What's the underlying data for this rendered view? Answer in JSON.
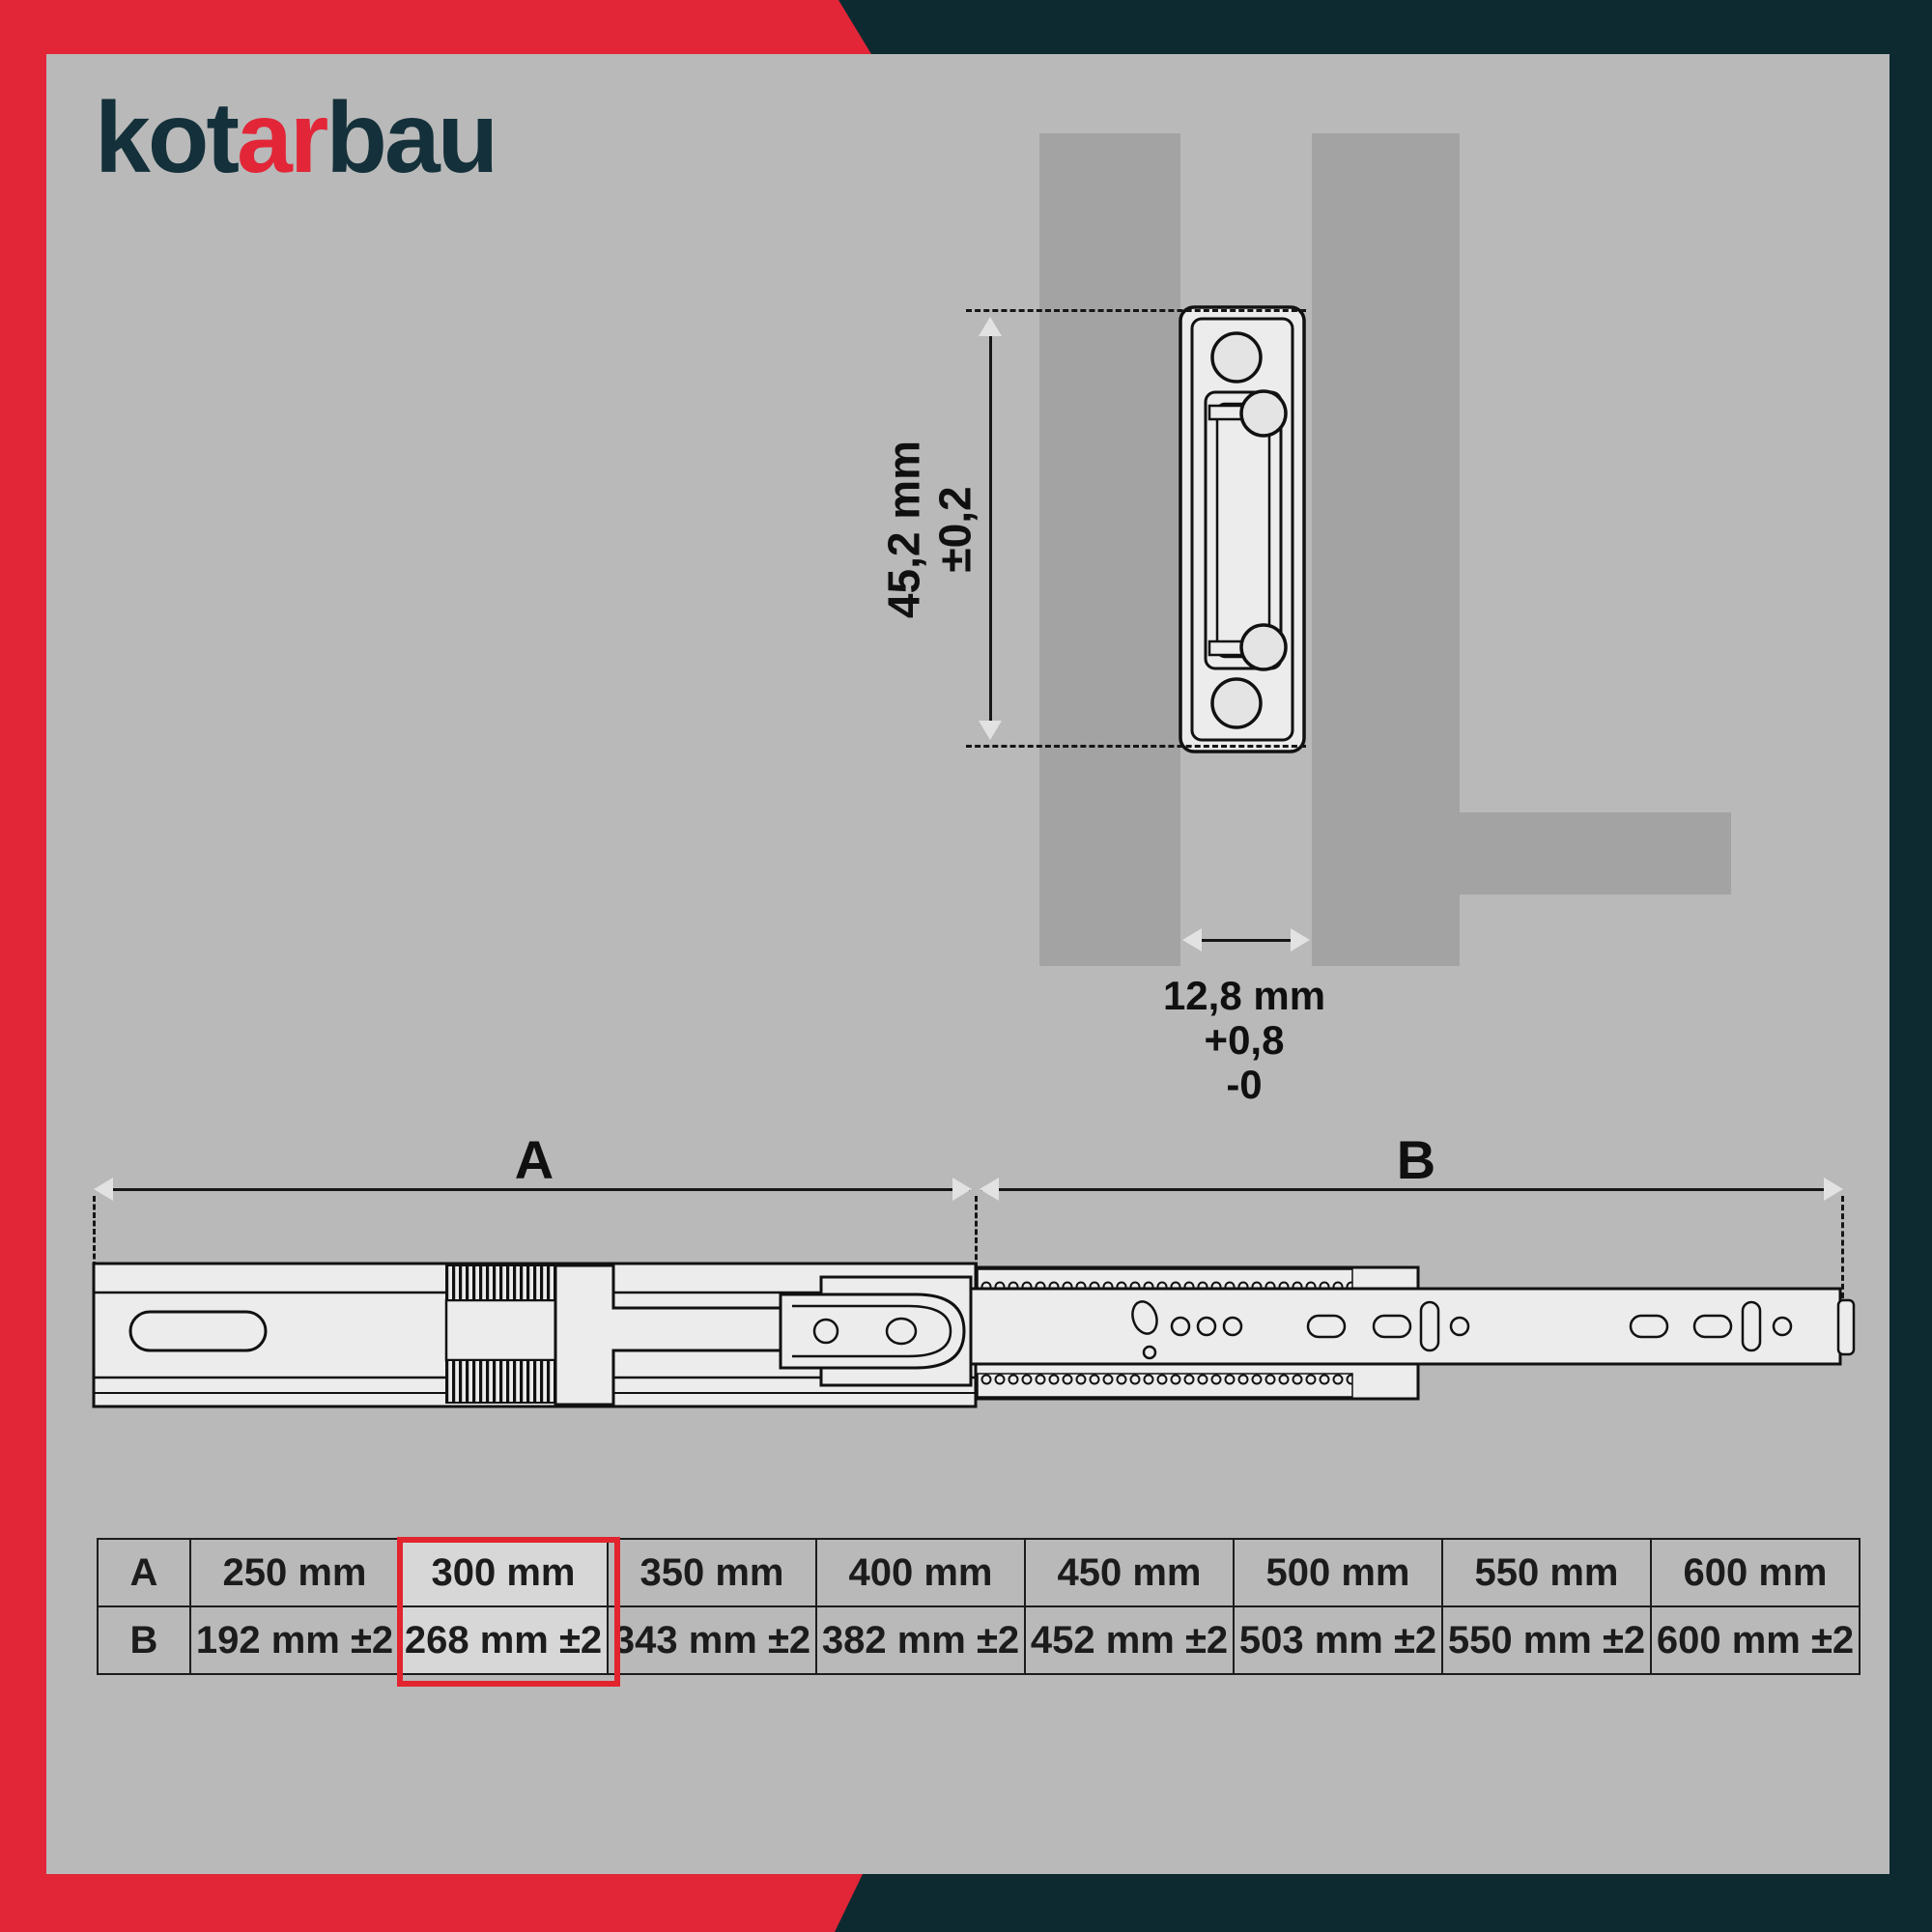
{
  "colors": {
    "brand_red": "#e22638",
    "brand_dark_teal": "#0d2a31",
    "background_gray": "#b9b9b9",
    "panel_gray": "#a3a3a3",
    "highlight_red": "#e2242f"
  },
  "logo": {
    "part1": "kot",
    "part2": "ar",
    "part3": "bau"
  },
  "cross_section": {
    "height_label_line1": "45,2 mm",
    "height_label_line2": "±0,2",
    "gap_label_line1": "12,8 mm",
    "gap_label_line2": "+0,8",
    "gap_label_line3": "-0"
  },
  "side_view": {
    "label_a": "A",
    "label_b": "B"
  },
  "table": {
    "rows": [
      {
        "header": "A",
        "cells": [
          "250 mm",
          "300 mm",
          "350 mm",
          "400 mm",
          "450 mm",
          "500 mm",
          "550 mm",
          "600 mm"
        ]
      },
      {
        "header": "B",
        "cells": [
          "192 mm ±2",
          "268 mm ±2",
          "343 mm ±2",
          "382 mm ±2",
          "452 mm ±2",
          "503 mm ±2",
          "550 mm ±2",
          "600 mm ±2"
        ]
      }
    ],
    "highlighted_column_index": 1
  }
}
